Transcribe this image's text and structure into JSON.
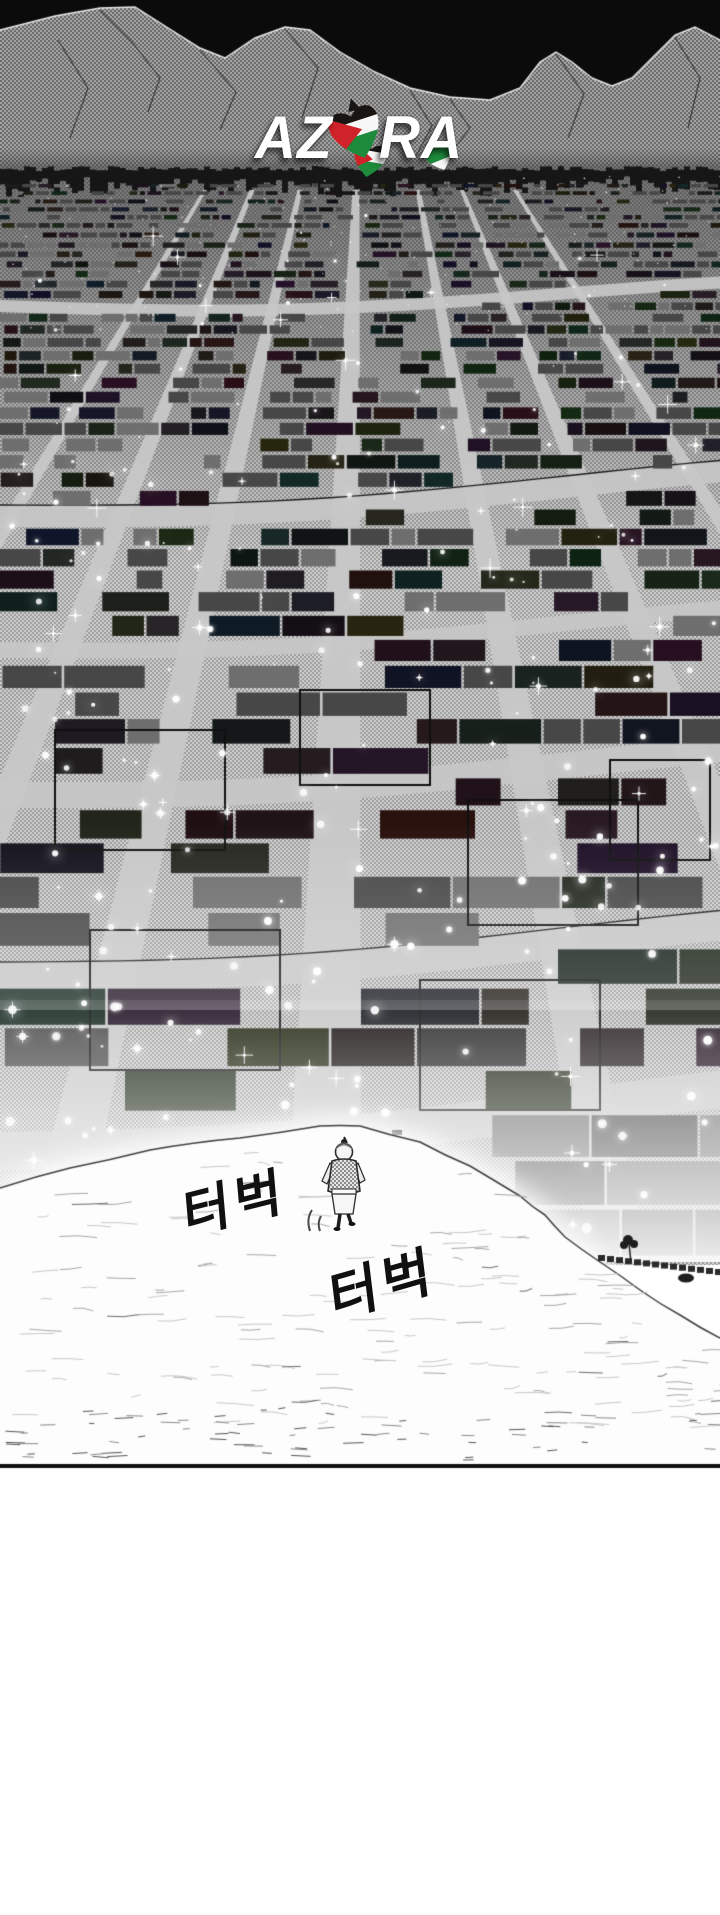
{
  "panel": {
    "logo": {
      "text": "AZORA",
      "part_left": "AZ",
      "part_right": "RA"
    },
    "sfx": [
      {
        "text": "터벅"
      },
      {
        "text": "터벅"
      }
    ],
    "colors": {
      "flag_black": "#181512",
      "flag_white": "#f7f7f7",
      "flag_green": "#1e8a3c",
      "flag_red": "#cf2229",
      "sky_black": "#0b0b0b",
      "ink": "#101010",
      "paper": "#ffffff"
    }
  }
}
